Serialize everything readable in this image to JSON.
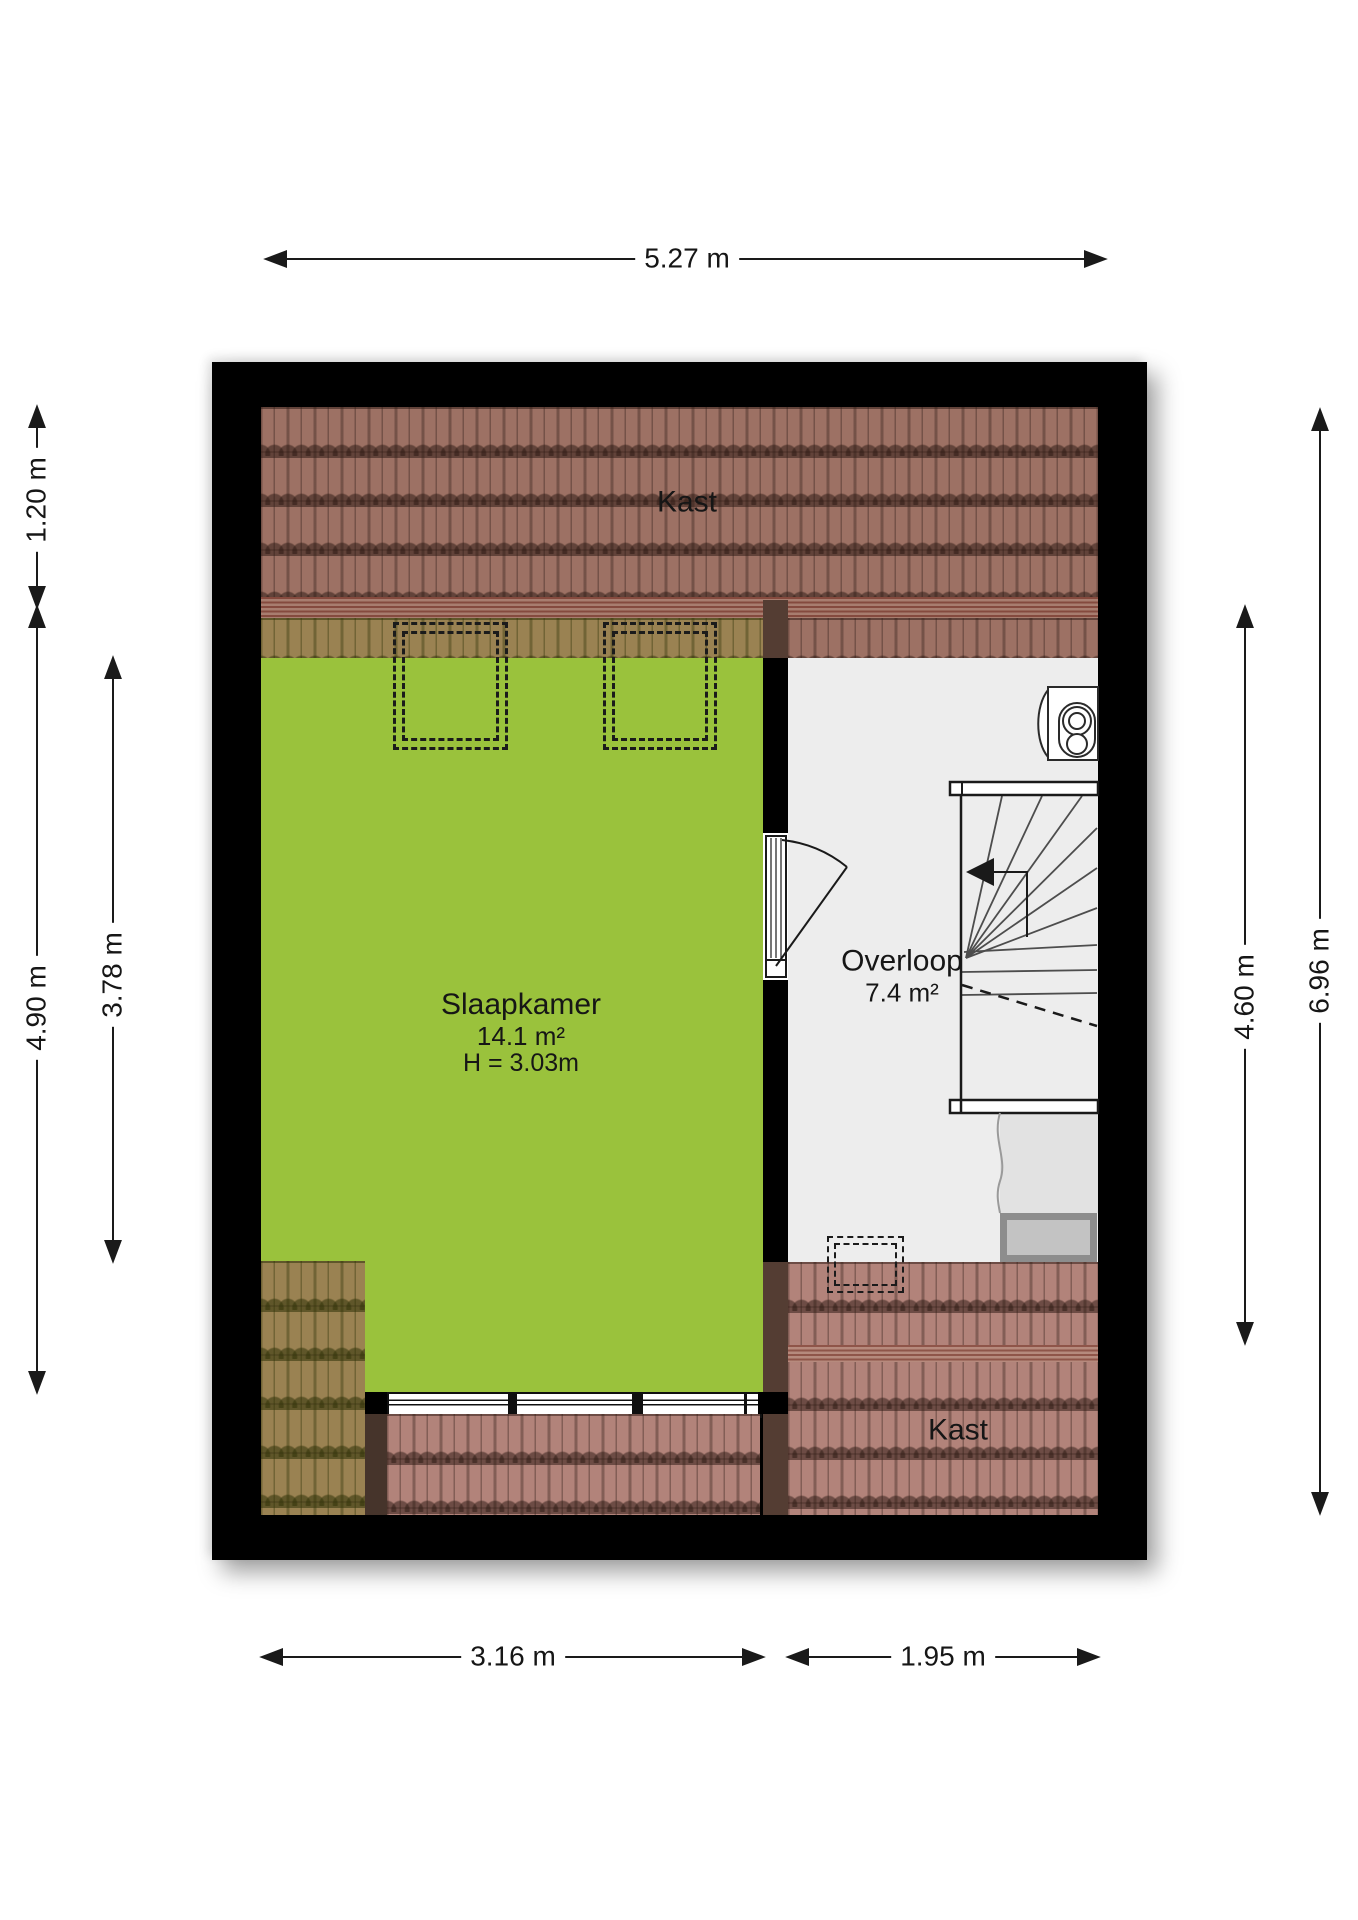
{
  "title": "Floor plan - attic storey",
  "colors": {
    "room_green": "#9ac23c",
    "roof_tile_brown": "#9d7164",
    "roof_tile_pink": "#b2837a",
    "roof_tile_blend": "#9a8252",
    "wall_black": "#000000",
    "floor_gray": "#ededed"
  },
  "dimensions": {
    "top": "5.27 m",
    "left_outer_upper": "1.20 m",
    "left_outer_lower": "4.90 m",
    "left_inner": "3.78 m",
    "right_inner": "4.60 m",
    "right_outer": "6.96 m",
    "bottom_left": "3.16 m",
    "bottom_right": "1.95 m"
  },
  "rooms": {
    "kast_top": {
      "label": "Kast"
    },
    "slaapkamer": {
      "label": "Slaapkamer",
      "area": "14.1 m²",
      "ceiling_height": "H = 3.03m"
    },
    "overloop": {
      "label": "Overloop",
      "area": "7.4 m²"
    },
    "kast_bottom": {
      "label": "Kast"
    }
  }
}
